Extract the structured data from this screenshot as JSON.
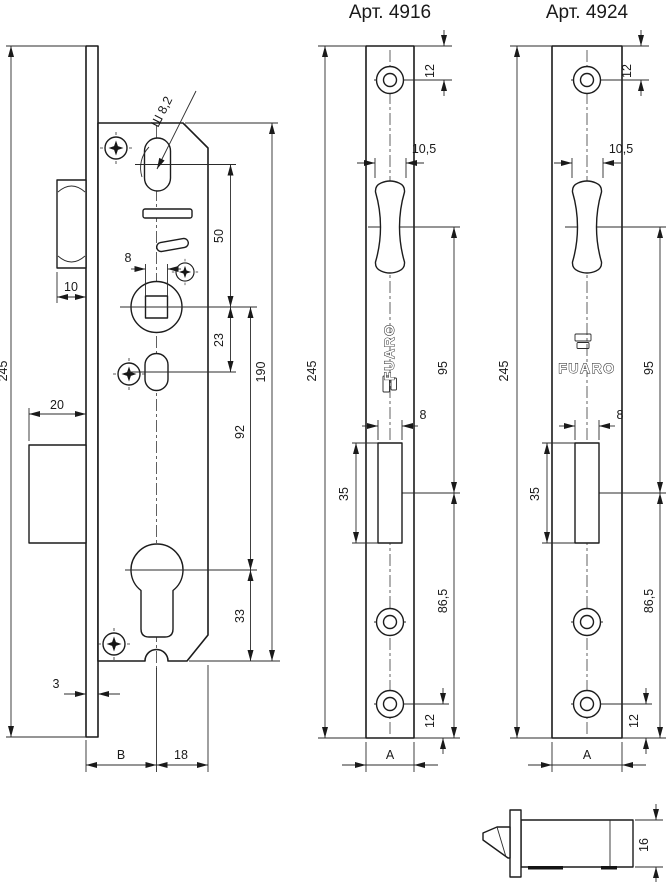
{
  "header": {
    "left_title": "Арт. 4916",
    "right_title": "Арт. 4924"
  },
  "brand": {
    "name": "FUARO"
  },
  "main_view": {
    "overall_height": "245",
    "latch_protrusion": "10",
    "deadbolt_protrusion": "20",
    "faceplate_thickness": "3",
    "oval_hole": "Ш 8,2",
    "spindle_square": "8",
    "oval_to_spindle": "50",
    "spindle_to_oval": "23",
    "spindle_to_cylinder": "92",
    "cylinder_to_bottom": "33",
    "body_height": "190",
    "backset": "B",
    "body_depth": "18"
  },
  "faceplate": {
    "height": "245",
    "screw_offset": "12",
    "latch_slot_width": "10,5",
    "latch_to_deadbolt": "95",
    "deadbolt_slot_width": "8",
    "deadbolt_slot_height": "35",
    "deadbolt_to_bottom": "86,5",
    "bottom_screw_offset": "12",
    "width": "A"
  },
  "side_view": {
    "height": "16"
  }
}
